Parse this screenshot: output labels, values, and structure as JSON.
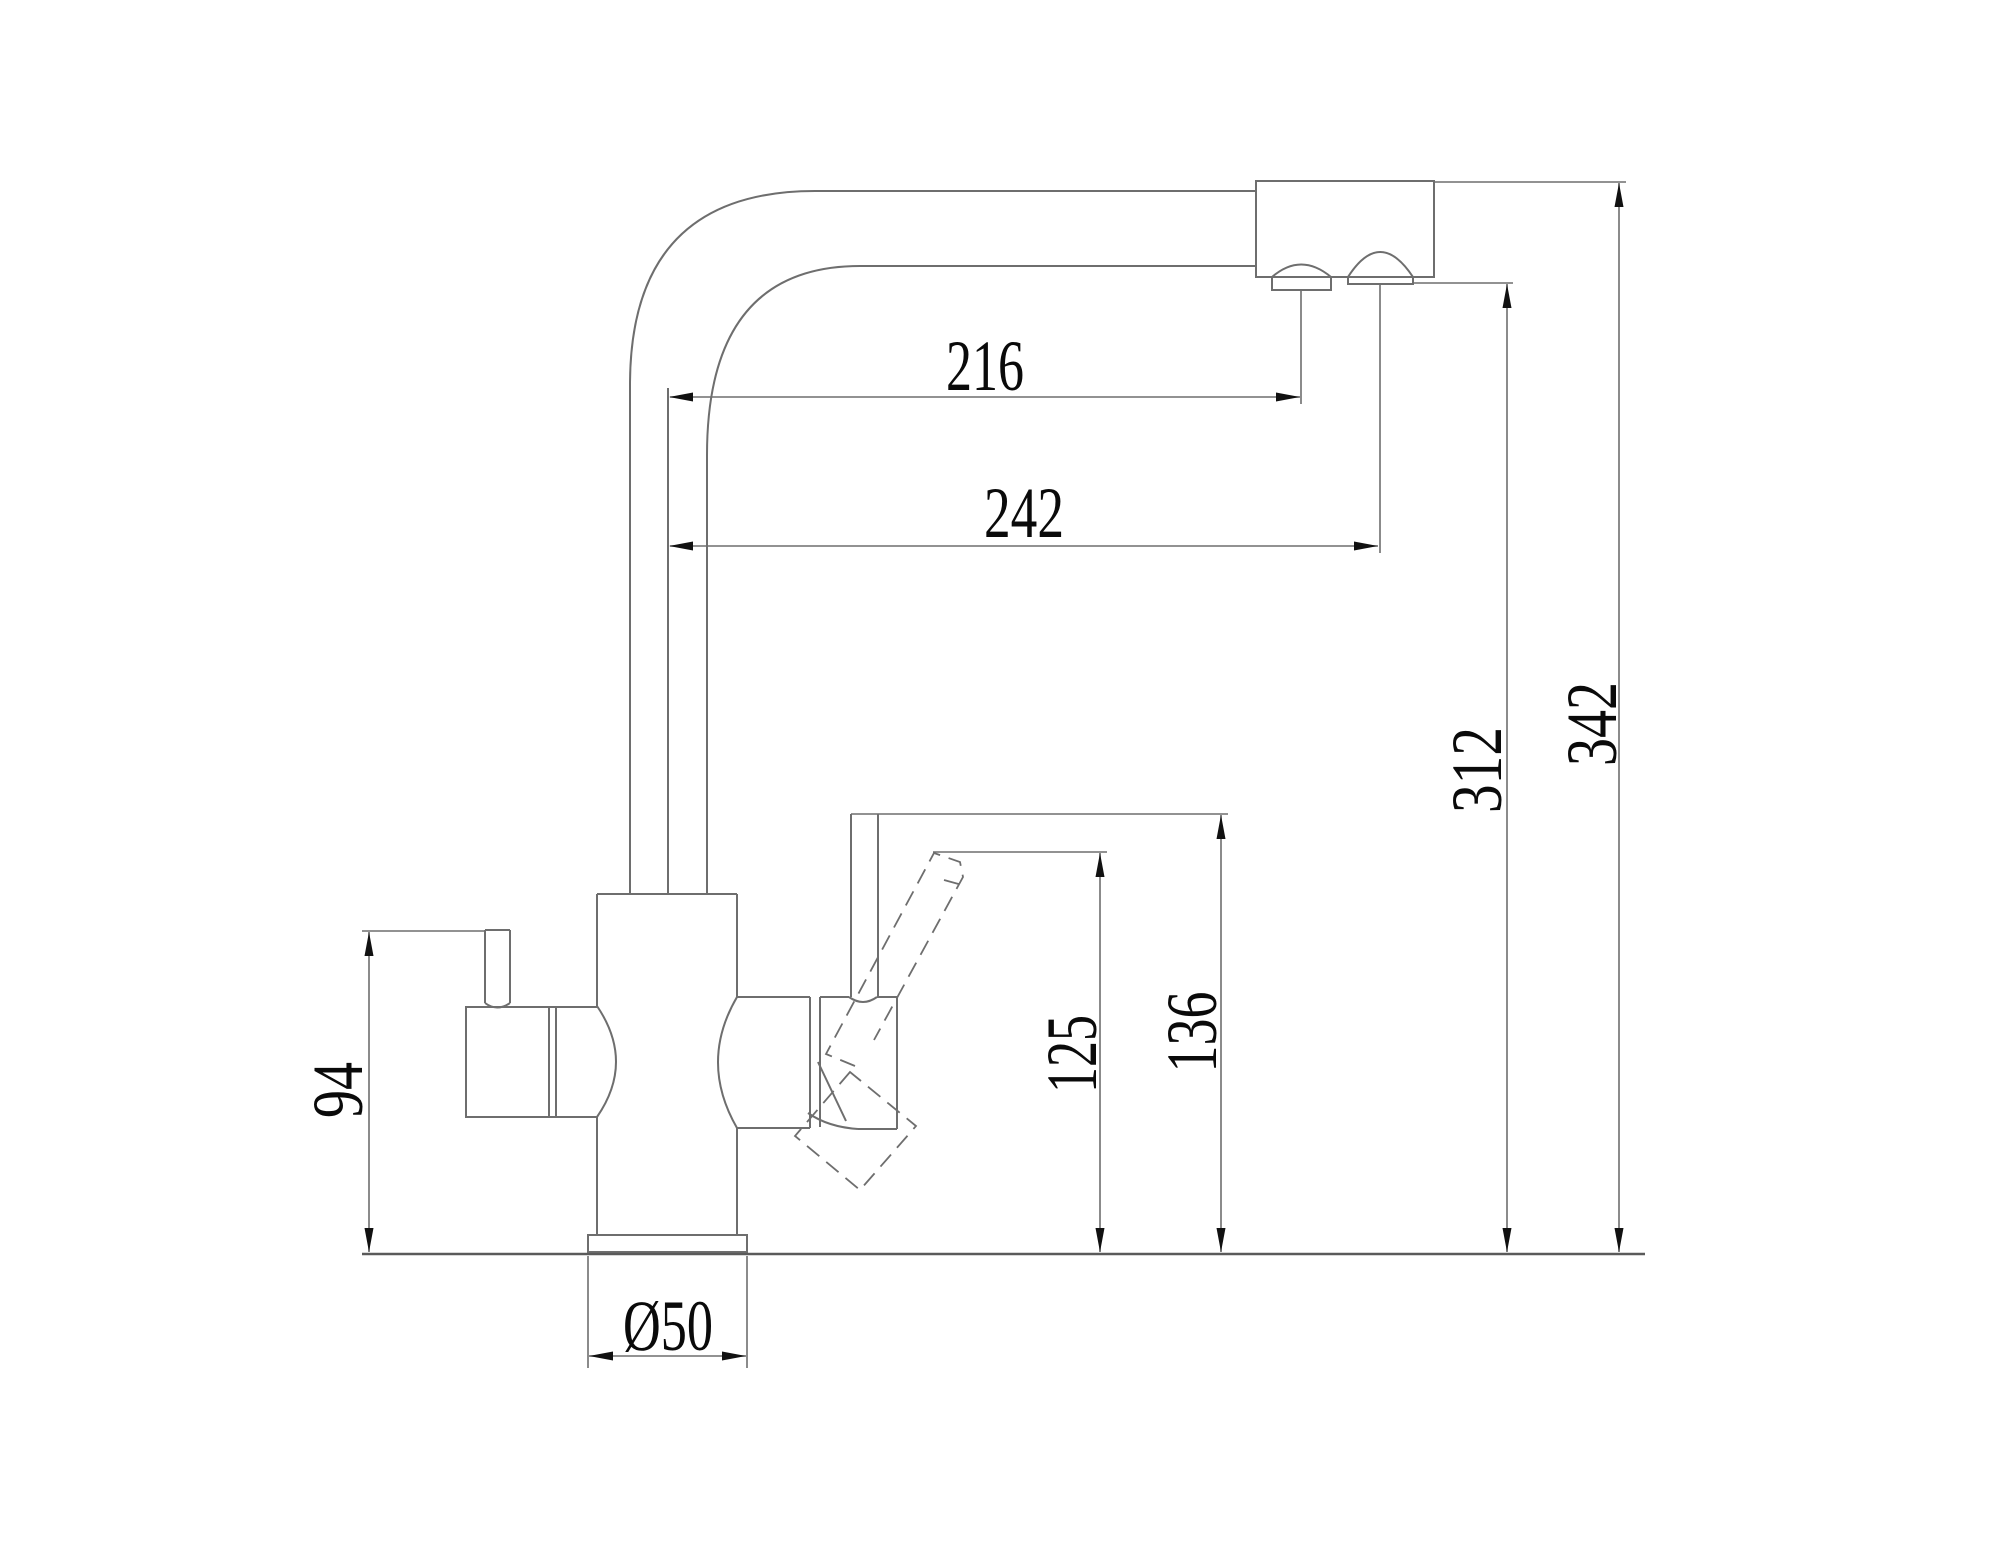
{
  "drawing": {
    "kind": "faucet-dimension-drawing",
    "background_color": "#ffffff",
    "outline_color": "#6e6e6e",
    "dimension_line_color": "#6e6e6e",
    "text_color": "#0a0a0a",
    "dimensions": {
      "spout_reach_upper": "216",
      "spout_reach_lower": "242",
      "height_to_outlet": "312",
      "height_overall": "342",
      "side_lever_height": "94",
      "handle_height_low": "125",
      "handle_height_top": "136",
      "base_diameter": "Ø50"
    }
  }
}
